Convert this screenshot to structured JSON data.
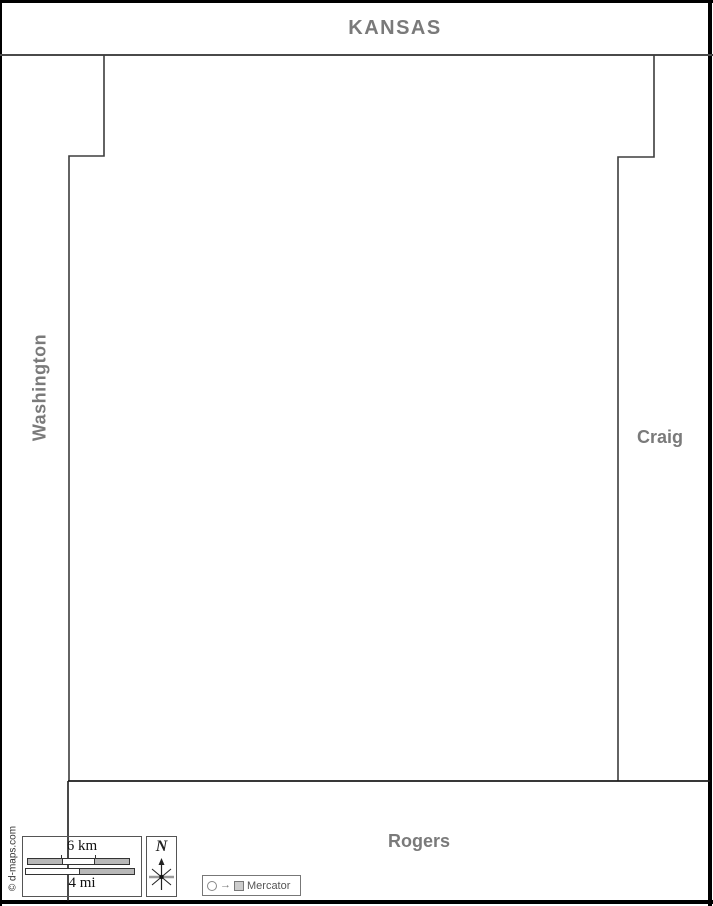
{
  "neighbor_labels": {
    "north": "KANSAS",
    "west": "Washington",
    "east": "Craig",
    "south": "Rogers"
  },
  "scale_bar": {
    "km_label": "6 km",
    "km_segments": 3,
    "mi_label": "4 mi",
    "mi_segments": 2
  },
  "compass": {
    "north_letter": "N"
  },
  "projection": {
    "arrow": "→",
    "name": "Mercator"
  },
  "credit": {
    "text": "© d-maps.com"
  },
  "colors": {
    "label_gray": "#7a7a7a",
    "county_border": "#3d3d3d",
    "frame_black": "#000000",
    "scale_fill_gray": "#b8b8b8",
    "box_border_gray": "#555555",
    "projection_gray": "#777777"
  }
}
